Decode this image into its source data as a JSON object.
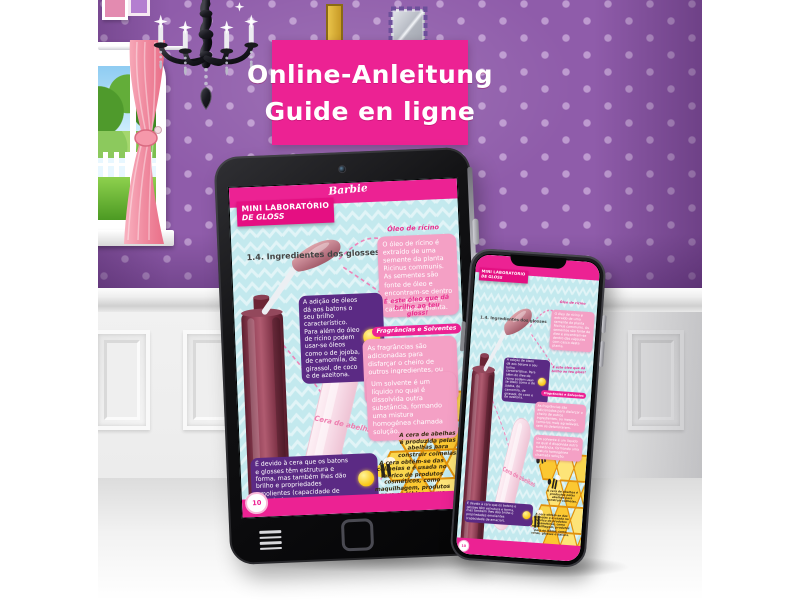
{
  "banner": {
    "line1": "Online-Anleitung",
    "line2": "Guide en ligne",
    "bg": "#ec2293"
  },
  "page": {
    "brand": "Barbie",
    "title_line1": "MINI LABORATÓRIO",
    "title_line2": "DE GLOSS",
    "section_heading": "1.4. Ingredientes dos glosses",
    "oleo_title": "Óleo de rícino",
    "oleo_text": "O óleo de rícino é extraído de uma semente da planta Ricinus communis. As sementes são fonte de óleo e encontram-se dentro das cápsulas com casca desta planta.",
    "note_brilho": "É este óleo que dá brilho ao teu gloss!",
    "frag_title": "Fragrâncias e Solventes",
    "frag_text1": "As fragrâncias são adicionadas para disfarçar o cheiro de outros ingredientes, ou mesmo torná-los mais agradáveis, sem os deteriorarem.",
    "frag_text2": "Um solvente é um líquido no qual é dissolvida outra substância, formando uma mistura homogénea chamada solução.",
    "bulb_text1": "A adição de óleos dá aos batons o seu brilho característico. Para além do óleo de rícino podem usar-se óleos como o de jojoba, de camomila, de girassol, de coco e de azeitona.",
    "bulb_text2": "É devido à cera que os batons e glosses têm estrutura e forma, mas também lhes dão brilho e propriedades emolientes (capacidade de amaciar).",
    "honey_note1": "A cera de abelhas é produzida pelas abelhas para construir colmeias.",
    "honey_note2": "A cera obtém-se das colmeias e é usada no fabrico de produtos cosméticos, como maquilhagem, produtos para os lábios, como ceras, glosses e batons.",
    "cera_label": "Cera de abelhas",
    "page_number": "10"
  },
  "icons": {
    "forward": "›",
    "tablet_nav": [
      "menu-icon",
      "home-button",
      "forward-icon"
    ]
  },
  "colors": {
    "banner_pink": "#ec2293",
    "page_header_pink": "#ec2293",
    "tip_box_purple": "#5b2a84",
    "info_box_pink": "#f4a0c5",
    "screen_background": "#c3e9ee",
    "honey_yellow": "#fbc832",
    "wallpaper_purple": "#8f5caa",
    "tube_maroon": "#83374c"
  }
}
